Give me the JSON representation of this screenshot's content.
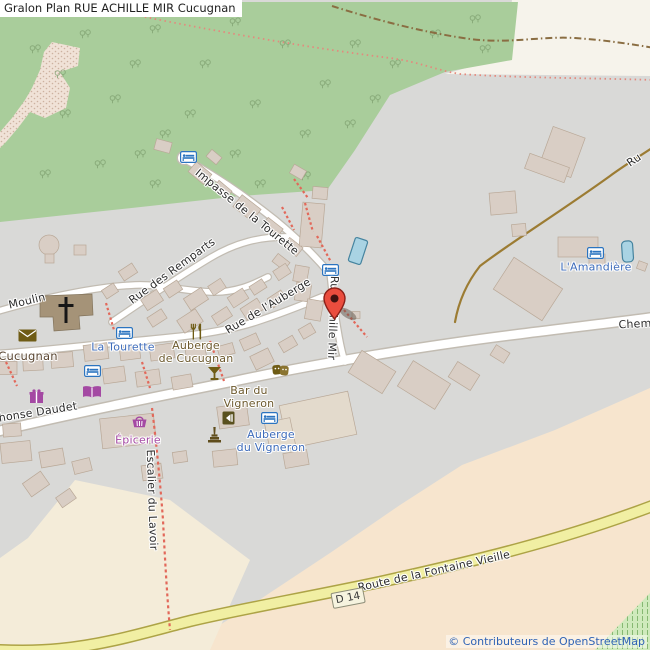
{
  "title": "Gralon Plan RUE ACHILLE MIR Cucugnan",
  "attribution": "© Contributeurs de OpenStreetMap",
  "badge": {
    "d14": "D 14"
  },
  "streets": {
    "impasse_tourette": "Impasse de la Tourette",
    "rue_des_remparts": "Rue des Remparts",
    "rue_de_lauberge": "Rue de l'Auberge",
    "rue_achille_mir": "Rue Achille Mir",
    "moulin": "Moulin",
    "alphonse_daudet_partial": "honse Daudet",
    "escalier_du_lavoir": "Escalier du Lavoir",
    "chemin_partial": "Chem",
    "rue_partial": "Ru",
    "route_fontaine_vieille": "Route de la Fontaine Vieille"
  },
  "places": {
    "cucugnan": "Cucugnan",
    "la_tourette": "La Tourette",
    "auberge_de_cucugnan": "Auberge\nde Cucugnan",
    "bar_du_vigneron": "Bar du\nVigneron",
    "auberge_du_vigneron": "Auberge\ndu Vigneron",
    "epicerie": "Épicerie",
    "amandiere": "L'Amandière"
  },
  "icons": {
    "marker": "red-map-pin",
    "lodging": "bed-icon",
    "church": "christian-cross-icon",
    "post": "envelope-icon",
    "restaurant": "fork-knife-icon",
    "bar": "cocktail-icon",
    "theatre": "theatre-masks-icon",
    "books": "open-book-icon",
    "gift": "gift-icon",
    "grocery": "basket-icon",
    "monument": "monument-icon",
    "artwork": "artwork-icon"
  },
  "colors": {
    "forest": "#a9cd9b",
    "residential": "#d9d9d7",
    "cream": "#f6f3eb",
    "farmland_peach": "#f7e5ce",
    "building": "#d9cec5",
    "road_yellow": "#f1efa3",
    "water": "#a9d3e3",
    "marker_red": "#ea4d3e",
    "poi_blue_label": "#3e6cba",
    "poi_purple": "#a449a3",
    "poi_amber": "#6f5c15",
    "path_red": "#e2685a",
    "attribution_blue": "#2f63b5"
  }
}
